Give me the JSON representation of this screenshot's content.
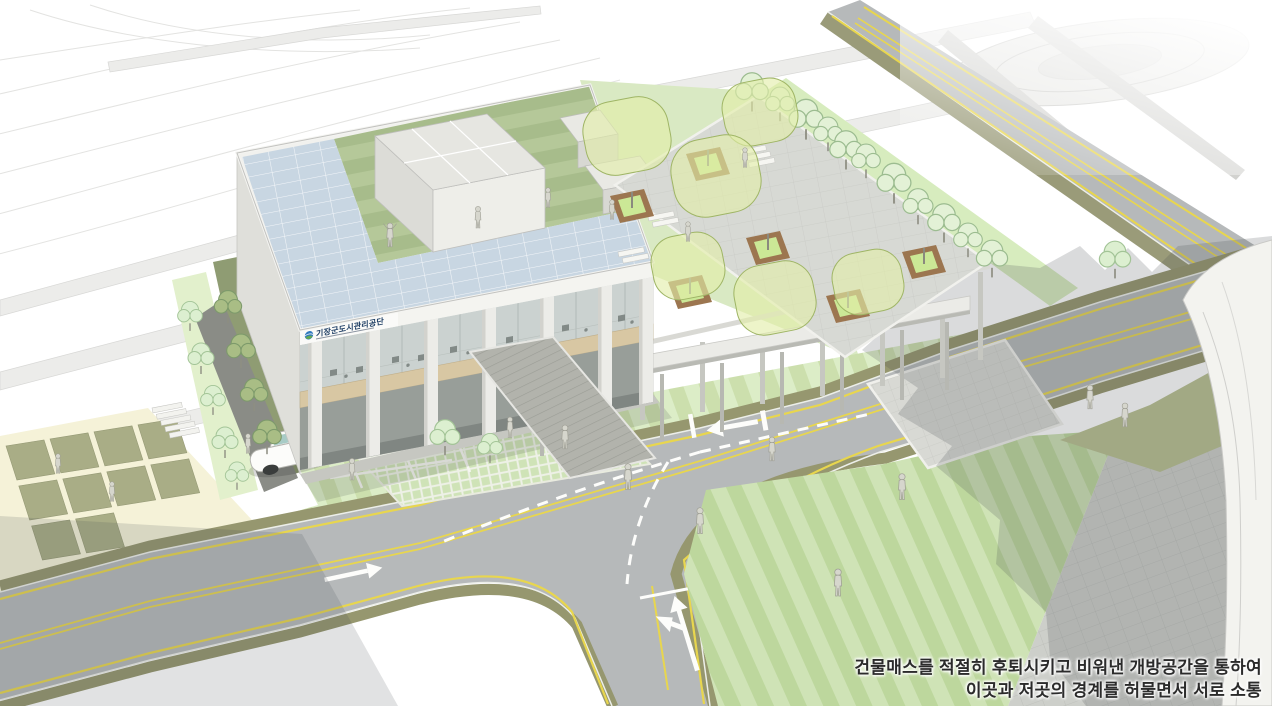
{
  "caption": {
    "line1": "건물매스를 적절히 후퇴시키고 비워낸 개방공간을 통하여",
    "line2": "이곳과 저곳의 경계를 허물면서 서로 소통"
  },
  "building": {
    "sign_text": "기장군도시관리공단"
  },
  "colors": {
    "solar_panel_blue": "#c8d6e2",
    "roof_lawn_green": "#a7bc8b",
    "ground_lawn_green": "#ccdfad",
    "se_lawn_green": "#bdd79d",
    "olive_lawn": "#b9c192",
    "road_gray": "#b6b9ba",
    "curb_olive": "#96976f",
    "lane_yellow": "#e8d64e",
    "marking_white": "#fdfdfb",
    "plaza_paver_gray": "#cdcfca",
    "cream_ground": "#f5f2d8",
    "planter_wood_brown": "#9c7650",
    "planter_grass": "#cbe896",
    "tree_canopy_translucent": "#e2ee a8",
    "sketch_tree_green": "#e3f1d6",
    "building_white": "#e9e9e5",
    "wood_spandrel": "#d8c7a3",
    "sign_navy": "#1d3d63",
    "shadow_tint": "#464c52"
  }
}
